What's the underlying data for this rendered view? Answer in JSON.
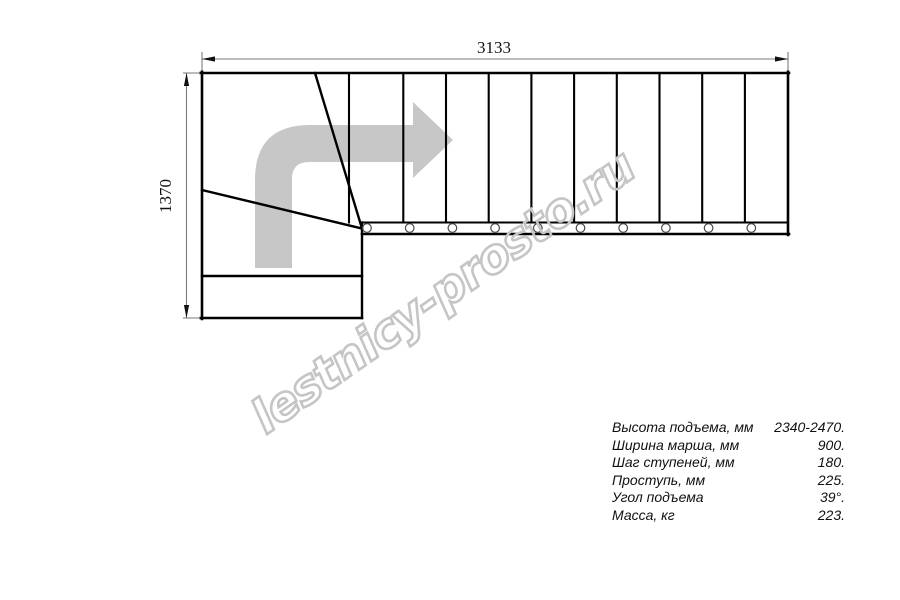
{
  "watermark": {
    "text": "lestnicy-prosto.ru"
  },
  "dimensions": {
    "top_width_mm": "3133",
    "left_depth_mm": "1370"
  },
  "specs": {
    "rows": [
      {
        "label": "Высота подъема, мм",
        "value": "2340-2470."
      },
      {
        "label": "Ширина марша, мм",
        "value": "900."
      },
      {
        "label": "Шаг ступеней, мм",
        "value": "180."
      },
      {
        "label": "Проступь, мм",
        "value": "225."
      },
      {
        "label": "Угол подъема",
        "value": "39°."
      },
      {
        "label": "Масса, кг",
        "value": "223."
      }
    ]
  },
  "plan": {
    "straight_steps": 10,
    "riser_xs": [
      349,
      403.3,
      446.0,
      488.7,
      531.4,
      574.1,
      616.8,
      659.5,
      702.2,
      744.9
    ],
    "baluster_xs": [
      367,
      409.7,
      452.4,
      495.1,
      537.8,
      580.5,
      623.2,
      665.9,
      708.6,
      751.3
    ],
    "colors": {
      "line": "#000000",
      "dimension": "#7a7a7a",
      "direction_arrow": "#c7c7c7",
      "watermark": "#c5c5c5"
    }
  }
}
